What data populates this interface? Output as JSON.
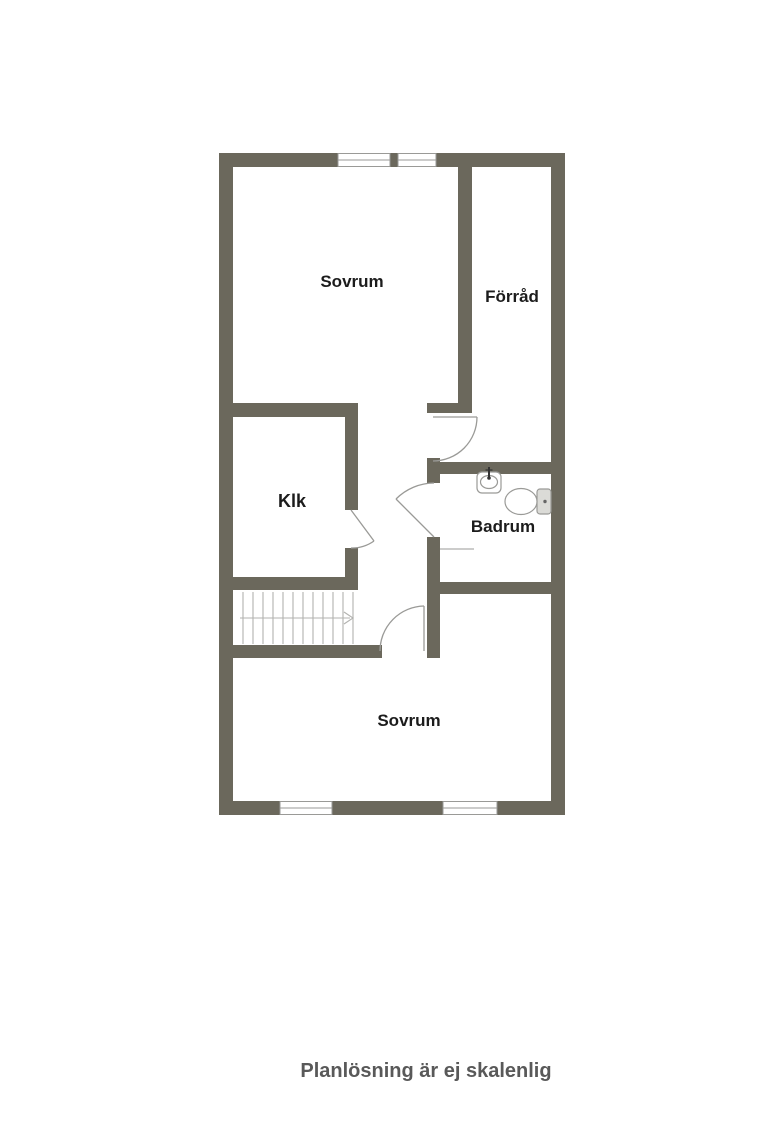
{
  "caption": "Planlösning är ej skalenlig",
  "colors": {
    "wall": "#6b685c",
    "line": "#9a9a97",
    "stair_line": "#b2b2af",
    "label_text": "#1c1c1c",
    "caption_text": "#595959",
    "fixture_fill": "#dbdbd7",
    "background": "#ffffff"
  },
  "rooms": [
    {
      "id": "sovrum-upper",
      "label": "Sovrum"
    },
    {
      "id": "forrad",
      "label": "Förråd"
    },
    {
      "id": "klk",
      "label": "Klk"
    },
    {
      "id": "badrum",
      "label": "Badrum"
    },
    {
      "id": "sovrum-lower",
      "label": "Sovrum"
    }
  ]
}
